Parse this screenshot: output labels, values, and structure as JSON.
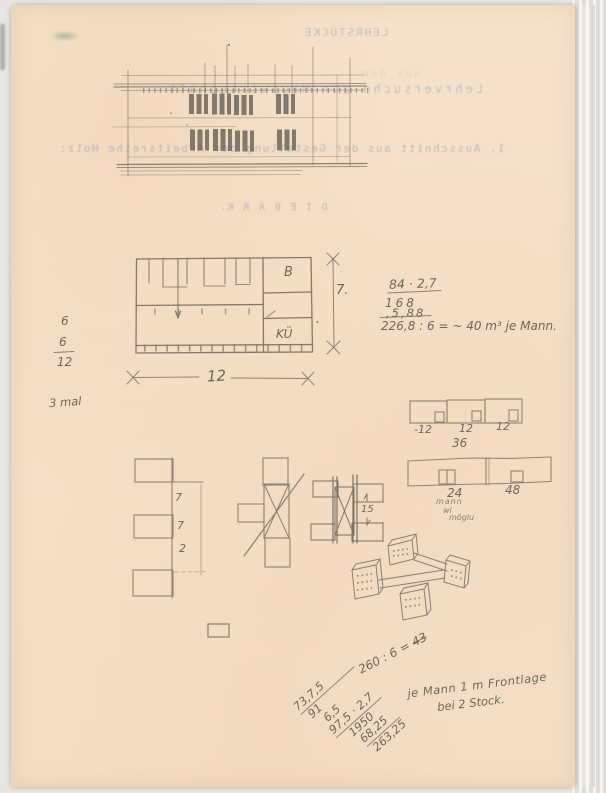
{
  "colors": {
    "paper": "#f5e2ca",
    "pencil": "#6e675a",
    "bleedthrough_ink": "#7385aa"
  },
  "bleedthrough": {
    "title": "LEHRSTÜCKE",
    "ghost_line": "aus dem",
    "subtitle": "Lehrversuche zur Hauswirtschaft",
    "caption": "1. Ausschnitt aus der Gestellung der Arbeitsreihe Holz:",
    "heading": "D I E   B A R K."
  },
  "plan": {
    "room_top": "B",
    "room_bottom": "KÜ",
    "width_dim": "12",
    "height_dim": "7."
  },
  "margin_notes": {
    "frac_num1": "6",
    "frac_num2": "6",
    "frac_den": "12",
    "times_note": "3 mal"
  },
  "volume_calc": {
    "line1": "84 · 2,7",
    "line2": "168",
    "line3": ",5,88",
    "result": "226,8 : 6 = ~ 40 m³ je Mann."
  },
  "unit_row": {
    "d1": "-12",
    "d2": "12",
    "d3": "12",
    "total": "36"
  },
  "strip": {
    "d1": "24",
    "d2": "48",
    "note1": "mann",
    "note2": "wi",
    "note3": "möglu"
  },
  "stack": {
    "g1": "7",
    "g2": "7",
    "g3": "2"
  },
  "rails": {
    "dim": "15"
  },
  "bottom_calc": {
    "division": "260 : 6 =",
    "division_result": "43",
    "note_line1": "je Mann 1 m Frontlage",
    "note_line2": "bei 2 Stock.",
    "col1": "73,7,5",
    "col2": "91",
    "col3": "6,5",
    "col4": "97,5 · 2,7",
    "col5": "1950",
    "col6": "68,25",
    "col7": "263,25"
  }
}
